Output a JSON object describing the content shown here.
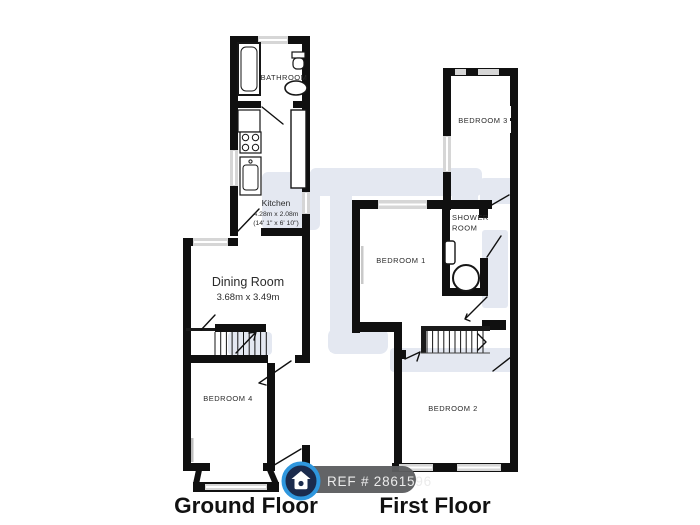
{
  "ground_floor": {
    "label": "Ground Floor",
    "bathroom_label": "BATHROOM",
    "kitchen_label": "Kitchen",
    "kitchen_dims_metric": "4.28m x 2.08m",
    "kitchen_dims_imperial": "(14' 1\" x 6' 10\")",
    "dining_label": "Dining Room",
    "dining_dims_metric": "3.68m x 3.49m",
    "bedroom4_label": "BEDROOM 4"
  },
  "first_floor": {
    "label": "First Floor",
    "bedroom3_label": "BEDROOM 3",
    "shower_room_label_line1": "SHOWER",
    "shower_room_label_line2": "ROOM",
    "bedroom1_label": "BEDROOM 1",
    "bedroom2_label": "BEDROOM 2"
  },
  "badge": {
    "ref_text": "REF # 2861596"
  },
  "colors": {
    "wall": "#101010",
    "window_fill": "#d6d6d6",
    "watermark": "#e4e8f1",
    "badge_background": "#5d5e60",
    "badge_text": "#ebebeb",
    "logo_ring": "#2f97de",
    "logo_navy": "#1b2b4d",
    "label_text": "#2b2b2b"
  }
}
